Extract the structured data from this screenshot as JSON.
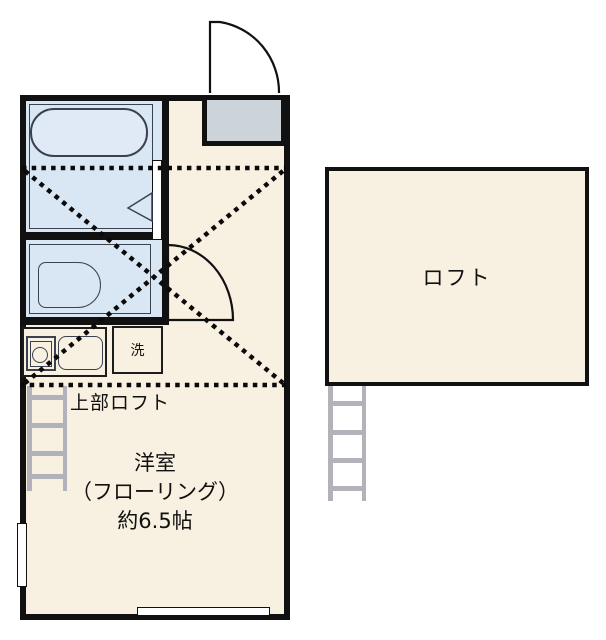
{
  "plan": {
    "title_hint": "apartment floor plan",
    "labels": {
      "upper_loft": "上部ロフト",
      "main_room_line1": "洋室",
      "main_room_line2": "（フローリング）",
      "main_room_line3": "約6.5帖",
      "loft": "ロフト",
      "washer": "洗"
    },
    "colors": {
      "floor": "#f8f0e0",
      "wet_area": "#d9e6f3",
      "entry_step": "#ccd3d9",
      "wall": "#111111",
      "fixture_outline": "#3a4250",
      "ladder": "#b2b2ba"
    }
  }
}
